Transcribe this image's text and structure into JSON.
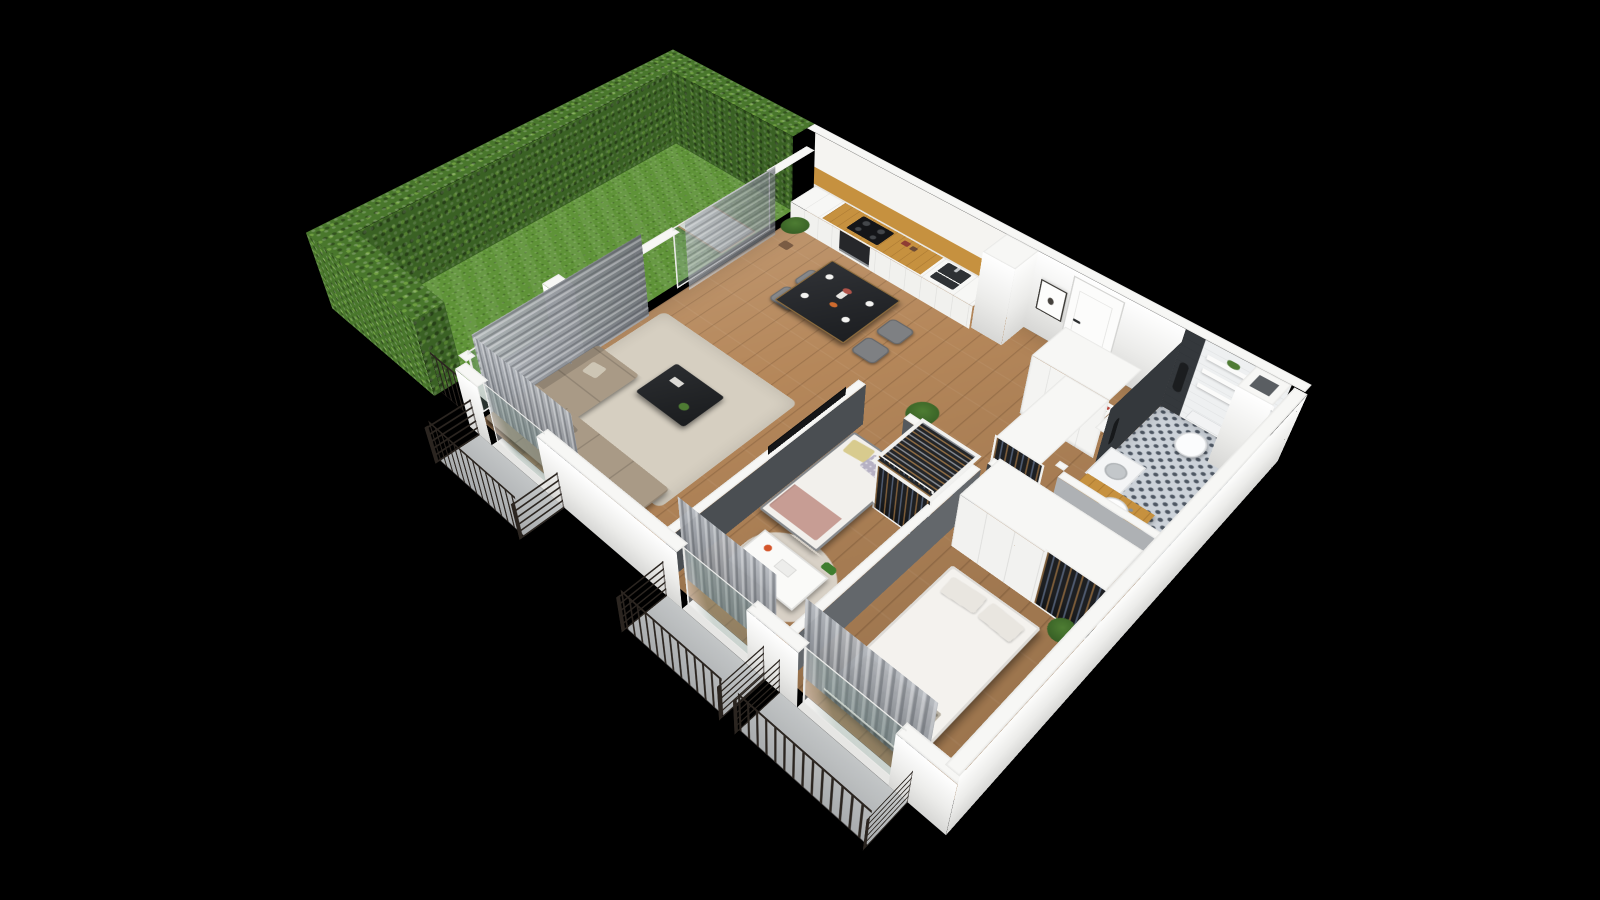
{
  "title": "isometric-apartment-floor-plan-3d-render",
  "background": "#000000",
  "colors": {
    "bg": "#000000",
    "wall_top": "#f7f7f5",
    "wall_face": "#ececea",
    "wall_shade": "#d7d7d5",
    "wood_floor": "#b5875a",
    "counter_wood": "#c6913f",
    "grass": "#5f9338",
    "hedge": "#49772c",
    "hedge_dark": "#3a6124",
    "tile_light": "#ccd2d9",
    "tile_dark": "#4e5763",
    "dark_wall": "#34383c",
    "curtain": "#9a9ea3",
    "railing": "#2b2520",
    "sofa": "#a99a86",
    "rug": "#d6cfc1",
    "furniture_dark": "#26282b",
    "textile_white": "#f2f0ec",
    "clothes_dark": "#1d1f22"
  },
  "camera": {
    "rotate_x_deg": 45,
    "rotate_z_deg": 44,
    "scale": 0.78,
    "perspective_px": 1200
  },
  "garden": {
    "lawn": "grass",
    "hedge_sides": [
      "north",
      "west",
      "south"
    ],
    "items": [
      "sun-lounger"
    ],
    "railing_segments": 1,
    "terrace_pad": true
  },
  "rooms": [
    {
      "name": "living-room-kitchen",
      "floor": "oak-planks",
      "items": [
        "kitchen-cabinet-run",
        "wood-counter",
        "cooktop",
        "oven",
        "sink",
        "upper-cabinets-wood-shelf",
        "dining-table",
        "dining-chairs-x4",
        "table-setting-plates",
        "flower-vase",
        "orange-bowl",
        "corner-sofa",
        "toss-pillows",
        "coffee-table",
        "area-rug",
        "wall-tv",
        "tall-grey-curtains",
        "potted-plants-x2",
        "glazed-garden-doors"
      ]
    },
    {
      "name": "hallway",
      "floor": "oak-planks",
      "items": [
        "entrance-door",
        "framed-butterfly-art",
        "ventilation-shaft",
        "tall-white-closet",
        "open-closet-with-clothes",
        "potted-plant",
        "colorful-books-stack"
      ]
    },
    {
      "name": "kids-bedroom",
      "floor": "oak-planks",
      "items": [
        "single-bed",
        "yellow-pillow",
        "polka-dot-pillow",
        "rose-blanket",
        "open-wardrobe-with-clothes",
        "white-desk",
        "desk-lamp",
        "toy-dinosaur",
        "light-rug",
        "balcony-door",
        "grey-curtain"
      ]
    },
    {
      "name": "master-bedroom",
      "floor": "oak-planks",
      "items": [
        "double-bed",
        "white-duvet",
        "pillows-x2",
        "patterned-throw",
        "wardrobe-white-and-open-clothes",
        "potted-plant",
        "balcony-door",
        "grey-curtain"
      ]
    },
    {
      "name": "bathroom",
      "floor": "patterned-mosaic-tile",
      "items": [
        "toilet",
        "floating-shelves-x3",
        "shelf-plant",
        "hanging-towel",
        "dark-feature-wall",
        "white-tile-wall",
        "wood-vanity-counter",
        "sink-basin",
        "washer-unit",
        "roof-shaft-box"
      ]
    }
  ],
  "balconies": [
    {
      "off": "living-room",
      "elements": [
        "slab",
        "metal-railing"
      ]
    },
    {
      "off": "kids-bedroom",
      "elements": [
        "slab",
        "metal-railing"
      ]
    },
    {
      "off": "master-bedroom",
      "elements": [
        "slab",
        "metal-railing"
      ]
    }
  ]
}
